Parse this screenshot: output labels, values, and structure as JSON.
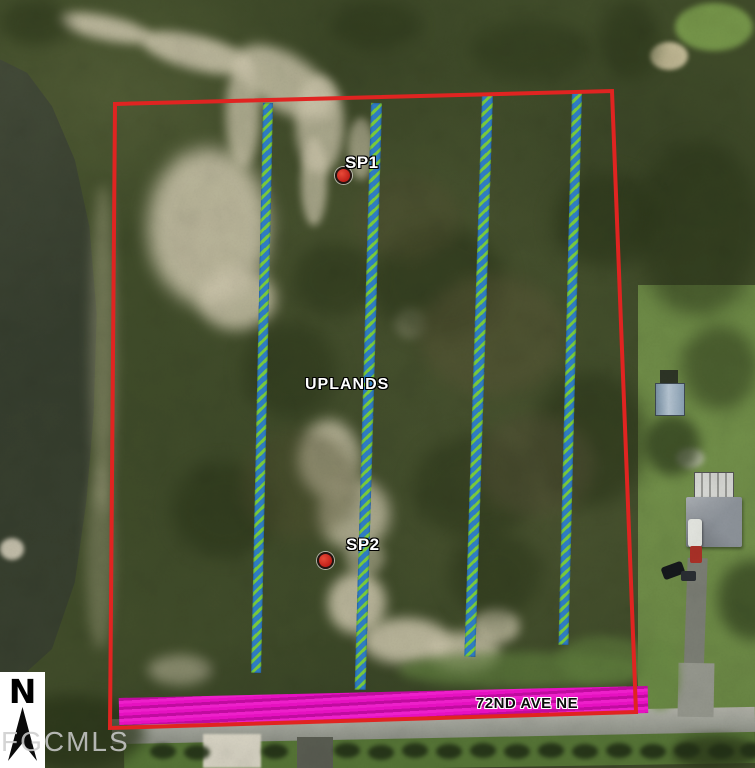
{
  "title": "Aerial parcel map",
  "map": {
    "markers": [
      {
        "id": "sp1",
        "label": "SP1"
      },
      {
        "id": "sp2",
        "label": "SP2"
      }
    ],
    "area_label": "UPLANDS",
    "road_label": "72ND AVE NE",
    "north_label": "N",
    "watermark": "FGCMLS",
    "colors": {
      "boundary": "#e02421",
      "transect_blue": "#2f7cc1",
      "transect_green": "#78c83c",
      "road_highlight": "#e611c1",
      "marker_fill": "#c02019",
      "water": "#39412f"
    }
  }
}
